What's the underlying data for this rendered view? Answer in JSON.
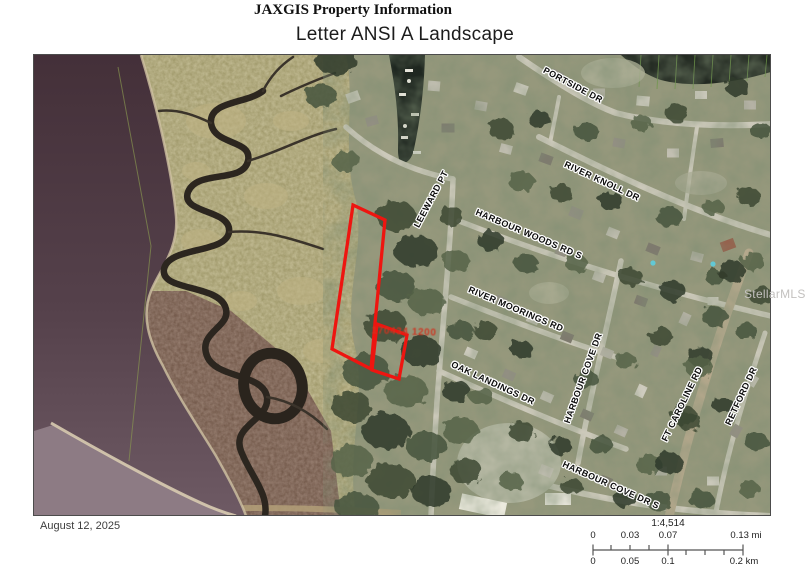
{
  "page": {
    "title": "JAXGIS Property Information",
    "subtitle": "Letter ANSI A Landscape"
  },
  "map": {
    "date": "August 12, 2025",
    "watermark": "StellarMLS",
    "parcel_id_label": "170434 1200",
    "highlight_color": "#ee1510",
    "offset": {
      "x": 33,
      "y": 54
    },
    "street_labels": [
      {
        "name": "portside-dr",
        "text": "PORTSIDE DR",
        "x": 572,
        "y": 84,
        "rot": 28
      },
      {
        "name": "river-knoll-dr",
        "text": "RIVER KNOLL DR",
        "x": 601,
        "y": 180,
        "rot": 25
      },
      {
        "name": "leeward-pt",
        "text": "LEEWARD PT",
        "x": 430,
        "y": 198,
        "rot": -62
      },
      {
        "name": "harbour-woods-rd-s",
        "text": "HARBOUR WOODS RD S",
        "x": 528,
        "y": 233,
        "rot": 23
      },
      {
        "name": "river-moorings-rd",
        "text": "RIVER MOORINGS RD",
        "x": 515,
        "y": 308,
        "rot": 23
      },
      {
        "name": "harbour-cove-dr",
        "text": "HARBOUR COVE DR",
        "x": 582,
        "y": 377,
        "rot": -70
      },
      {
        "name": "oak-landings-dr",
        "text": "OAK LANDINGS DR",
        "x": 492,
        "y": 382,
        "rot": 25
      },
      {
        "name": "ft-caroline-rd",
        "text": "FT CAROLINE RD",
        "x": 681,
        "y": 403,
        "rot": -64
      },
      {
        "name": "retford-dr",
        "text": "RETFORD DR",
        "x": 740,
        "y": 395,
        "rot": -65
      },
      {
        "name": "harbour-cove-dr-s",
        "text": "HARBOUR COVE DR S",
        "x": 610,
        "y": 484,
        "rot": 24
      }
    ]
  },
  "scalebar": {
    "ratio": "1:4,514",
    "mi_ticks": [
      "0",
      "0.03",
      "0.07",
      "0.13 mi"
    ],
    "km_ticks": [
      "0",
      "0.05",
      "0.1",
      "0.2 km"
    ]
  }
}
